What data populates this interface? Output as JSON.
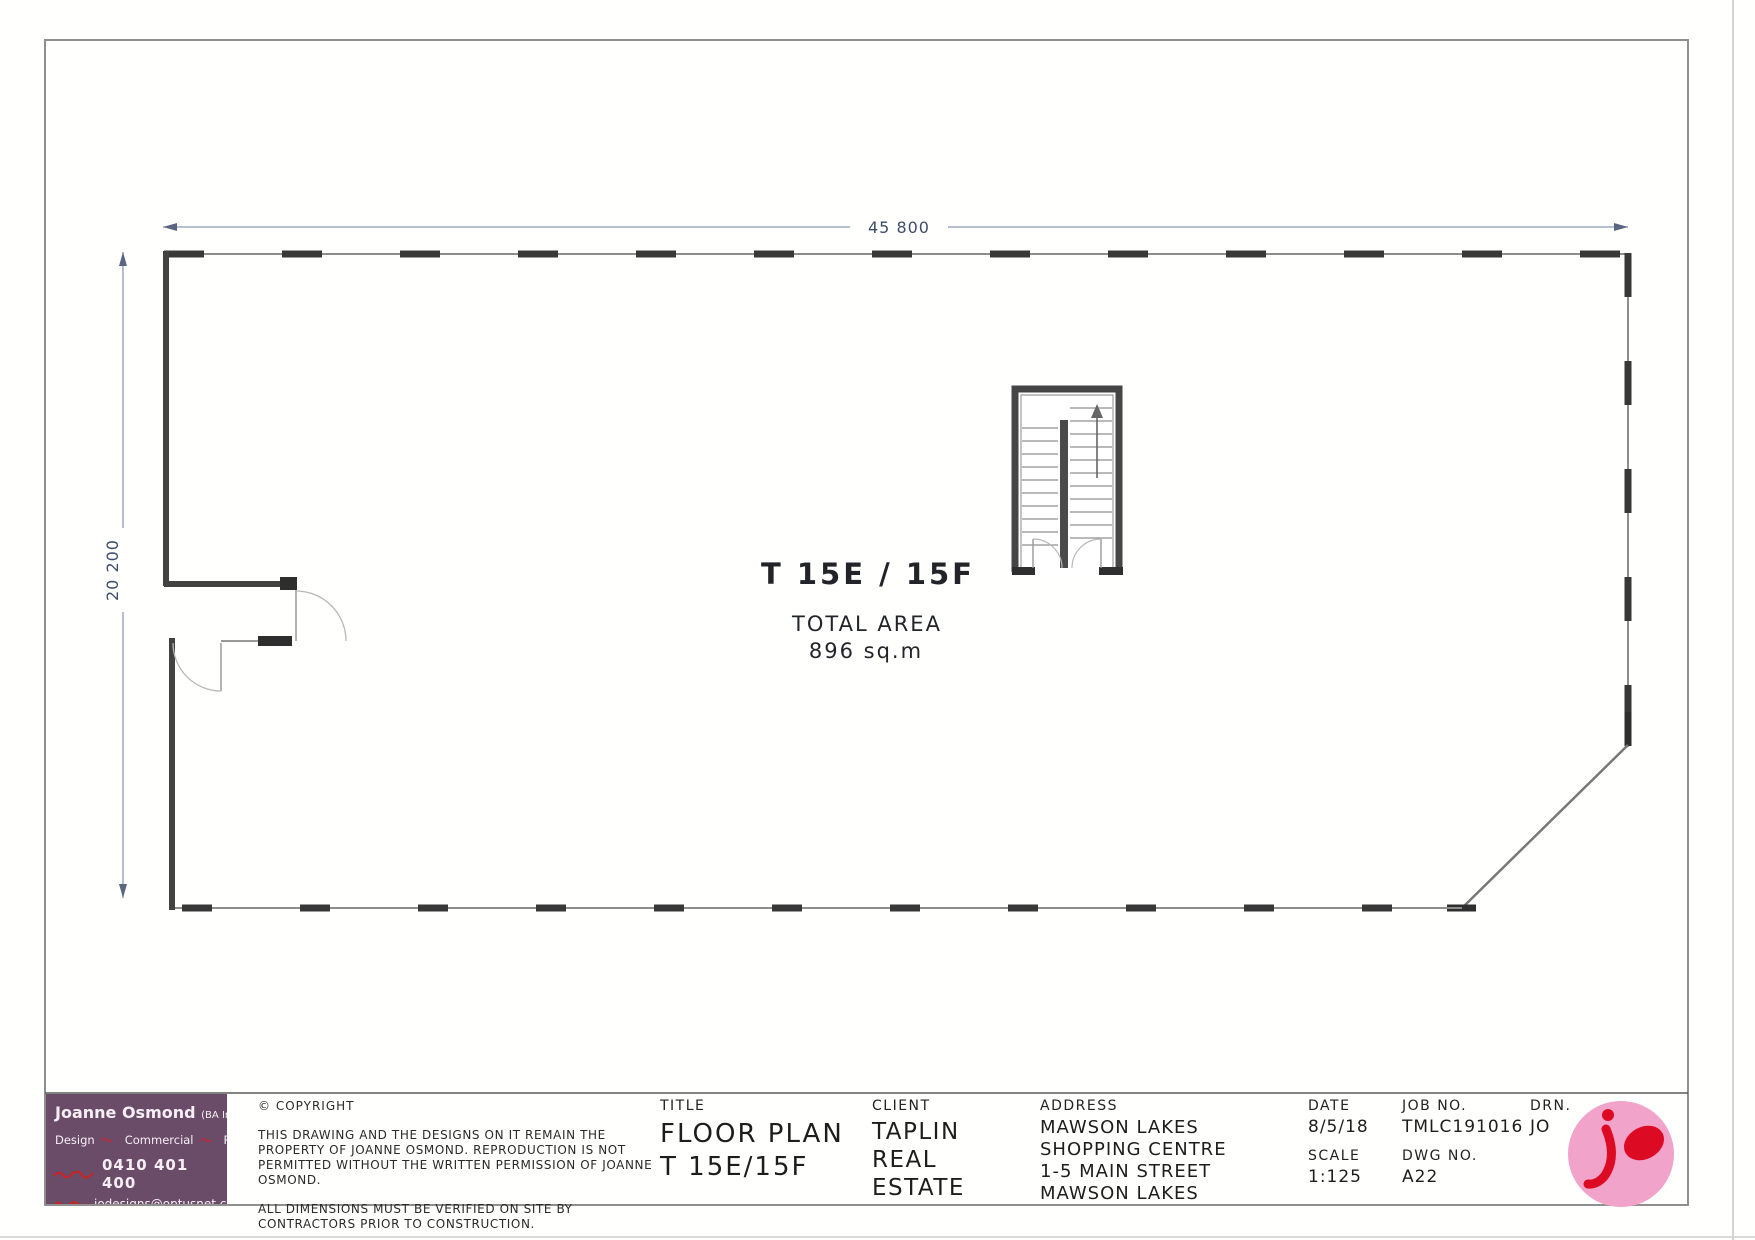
{
  "drawing": {
    "dimensions": {
      "top": "45 800",
      "left": "20 200"
    },
    "room": {
      "name": "T 15E / 15F",
      "area_label": "TOTAL AREA",
      "area_value": "896 sq.m"
    }
  },
  "title_block": {
    "business_card": {
      "name": "Joanne Osmond",
      "credentials": "(BA Int. Des.)",
      "services": [
        "Design",
        "Commercial",
        "Residential"
      ],
      "phone": "0410 401 400",
      "email": "jodesigns@optusnet.com.au"
    },
    "copyright": {
      "heading": "© COPYRIGHT",
      "body1": "THIS DRAWING AND THE DESIGNS ON IT REMAIN THE PROPERTY OF JOANNE OSMOND.  REPRODUCTION IS NOT PERMITTED WITHOUT THE WRITTEN PERMISSION OF JOANNE OSMOND.",
      "body2": "ALL DIMENSIONS MUST BE VERIFIED ON SITE BY CONTRACTORS PRIOR TO CONSTRUCTION."
    },
    "title": {
      "label": "TITLE",
      "line1": "FLOOR PLAN",
      "line2": "T 15E/15F"
    },
    "client": {
      "label": "CLIENT",
      "lines": [
        "TAPLIN",
        "REAL",
        "ESTATE"
      ]
    },
    "address": {
      "label": "ADDRESS",
      "lines": [
        "MAWSON LAKES",
        "SHOPPING CENTRE",
        "1-5 MAIN STREET",
        "MAWSON LAKES"
      ]
    },
    "date": {
      "label": "DATE",
      "value": "8/5/18"
    },
    "scale": {
      "label": "SCALE",
      "value": "1:125"
    },
    "job_no": {
      "label": "JOB NO.",
      "value": "TMLC191016"
    },
    "dwg_no": {
      "label": "DWG NO.",
      "value": "A22"
    },
    "drn": {
      "label": "DRN.",
      "value": "JO"
    }
  },
  "colors": {
    "card_purple": "#6a4c68",
    "logo_pink": "#f2a3c9",
    "logo_red": "#dd0a24",
    "dimension_line": "#8c99b8",
    "wall_dark": "#3c3c3c"
  }
}
